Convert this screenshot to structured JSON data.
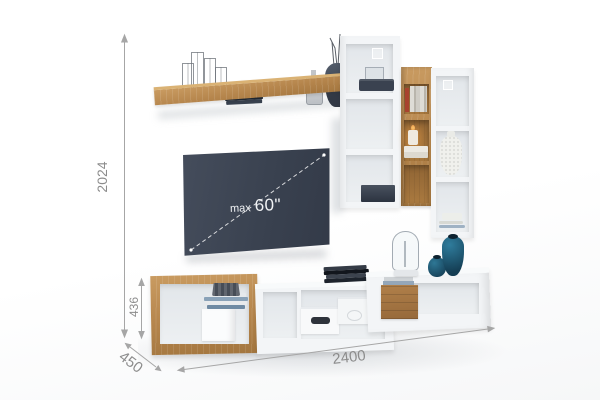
{
  "tv": {
    "label_prefix": "max",
    "label_size": "60\""
  },
  "dimensions": {
    "total_height_mm": "2024",
    "stand_height_mm": "436",
    "depth_mm": "450",
    "total_width_mm": "2400"
  },
  "colors": {
    "oak_wood": "#b5854c",
    "white_furniture": "#f3f5f7",
    "tv_screen": "#3b4353",
    "dimension_annotation": "#8c8c8c",
    "teal_decor": "#1f5b78",
    "dark_decor": "#3a414e",
    "background": "#ffffff"
  },
  "decor_icons": {
    "wall_shelf": [
      "wire-candleholders-icon",
      "books-stack-icon",
      "glass-bottle-icon",
      "dark-vase-branches-icon"
    ],
    "columns": [
      "glass-box-icon",
      "dark-tray-icon",
      "red-book-icon",
      "gray-books-icon",
      "candle-icon",
      "gift-boxes-icon",
      "white-vase-icon",
      "bowls-stack-icon",
      "dark-box-icon"
    ],
    "stand": [
      "woven-basket-icon",
      "books-stack-icon",
      "white-box-icon",
      "box-with-slot-icon",
      "box-with-label-icon",
      "black-folders-icon",
      "wooden-crate-icon",
      "glass-cloche-icon",
      "teal-vase-small-icon",
      "teal-vase-large-icon"
    ]
  }
}
